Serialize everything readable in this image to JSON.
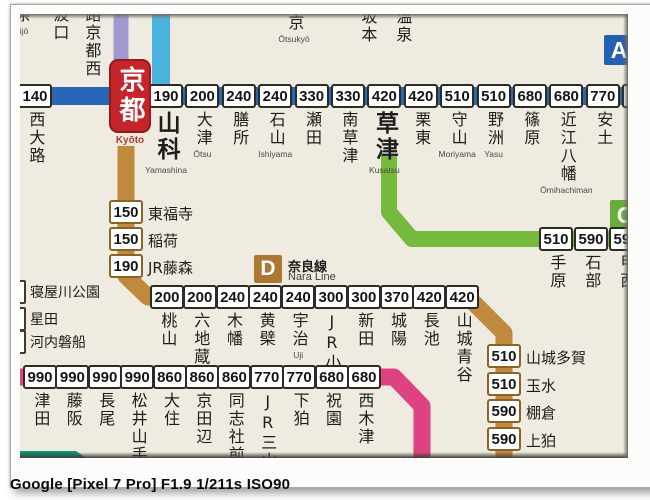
{
  "caption": "Google [Pixel 7 Pro] F1.9 1/211s ISO90",
  "badges": {
    "a": "A",
    "c": "C",
    "d": "D"
  },
  "nara_line_label": {
    "jp": "奈良線",
    "en": "Nara Line"
  },
  "kyoto": {
    "name": "京都",
    "romaji": "Kyōto"
  },
  "top_edge": {
    "sagano": [
      {
        "name": "条",
        "romaji": "Nijō"
      },
      {
        "name": "波口",
        "romaji": ""
      },
      {
        "name": "路京都西",
        "romaji": ""
      }
    ],
    "kosei": [
      {
        "name": "京",
        "romaji": "Ōtsukyō"
      },
      {
        "name": "坂本",
        "romaji": ""
      },
      {
        "name": "温泉",
        "romaji": ""
      }
    ]
  },
  "left_edge": [
    {
      "name": "寝屋川公園"
    },
    {
      "name": "星田"
    },
    {
      "name": "河内磐船"
    }
  ],
  "lines": {
    "biwako_west": [
      {
        "fare": "140",
        "name": "西大路",
        "romaji": ""
      }
    ],
    "biwako": [
      {
        "fare": "190",
        "name": "山科",
        "romaji": "Yamashina",
        "big": true
      },
      {
        "fare": "200",
        "name": "大津",
        "romaji": "Ōtsu"
      },
      {
        "fare": "240",
        "name": "膳所",
        "romaji": ""
      },
      {
        "fare": "240",
        "name": "石山",
        "romaji": "Ishiyama"
      },
      {
        "fare": "330",
        "name": "瀬田",
        "romaji": ""
      },
      {
        "fare": "330",
        "name": "南草津",
        "romaji": ""
      },
      {
        "fare": "420",
        "name": "草津",
        "romaji": "Kusatsu",
        "big": true
      },
      {
        "fare": "420",
        "name": "栗東",
        "romaji": ""
      },
      {
        "fare": "510",
        "name": "守山",
        "romaji": "Moriyama"
      },
      {
        "fare": "510",
        "name": "野洲",
        "romaji": "Yasu"
      },
      {
        "fare": "680",
        "name": "篠原",
        "romaji": ""
      },
      {
        "fare": "680",
        "name": "近江八幡",
        "romaji": "Ōmihachiman"
      },
      {
        "fare": "770",
        "name": "安土",
        "romaji": ""
      },
      {
        "fare": "820",
        "name": "能登川",
        "romaji": "Noto"
      }
    ],
    "nara_north": [
      {
        "fare": "150",
        "name": "東福寺"
      },
      {
        "fare": "150",
        "name": "稲荷"
      },
      {
        "fare": "190",
        "name": "JR藤森"
      }
    ],
    "nara": [
      {
        "fare": "200",
        "name": "桃山",
        "romaji": ""
      },
      {
        "fare": "200",
        "name": "六地蔵",
        "romaji": ""
      },
      {
        "fare": "240",
        "name": "木幡",
        "romaji": ""
      },
      {
        "fare": "240",
        "name": "黄檗",
        "romaji": ""
      },
      {
        "fare": "240",
        "name": "宇治",
        "romaji": "Uji"
      },
      {
        "fare": "300",
        "name": "JR小倉",
        "romaji": ""
      },
      {
        "fare": "300",
        "name": "新田",
        "romaji": ""
      },
      {
        "fare": "370",
        "name": "城陽",
        "romaji": ""
      },
      {
        "fare": "420",
        "name": "長池",
        "romaji": ""
      },
      {
        "fare": "420",
        "name": "山城青谷",
        "romaji": ""
      }
    ],
    "nara_south": [
      {
        "fare": "510",
        "name": "山城多賀"
      },
      {
        "fare": "510",
        "name": "玉水"
      },
      {
        "fare": "590",
        "name": "棚倉"
      },
      {
        "fare": "590",
        "name": "上狛"
      }
    ],
    "kusatsu": [
      {
        "fare": "510",
        "name": "手原",
        "romaji": ""
      },
      {
        "fare": "590",
        "name": "石部",
        "romaji": ""
      },
      {
        "fare": "590",
        "name": "甲西",
        "romaji": ""
      }
    ],
    "gakkentoshi": [
      {
        "fare": "990",
        "name": "津田",
        "romaji": ""
      },
      {
        "fare": "990",
        "name": "藤阪",
        "romaji": ""
      },
      {
        "fare": "990",
        "name": "長尾",
        "romaji": ""
      },
      {
        "fare": "990",
        "name": "松井山手",
        "romaji": ""
      },
      {
        "fare": "860",
        "name": "大住",
        "romaji": ""
      },
      {
        "fare": "860",
        "name": "京田辺",
        "romaji": ""
      },
      {
        "fare": "860",
        "name": "同志社前",
        "romaji": ""
      },
      {
        "fare": "770",
        "name": "JR三山木",
        "romaji": ""
      },
      {
        "fare": "770",
        "name": "下狛",
        "romaji": ""
      },
      {
        "fare": "680",
        "name": "祝園",
        "romaji": ""
      },
      {
        "fare": "680",
        "name": "西木津",
        "romaji": ""
      }
    ]
  },
  "colors": {
    "biwako_blue": "#2766b5",
    "kosei_cyan": "#49b3dd",
    "sagano_purple": "#a09ad0",
    "nara_brown": "#c08a3e",
    "kusatsu_green": "#76b93f",
    "gakkentoshi_pink": "#dc4380",
    "teal": "#0a9678",
    "kyoto_red": "#c5242b"
  }
}
